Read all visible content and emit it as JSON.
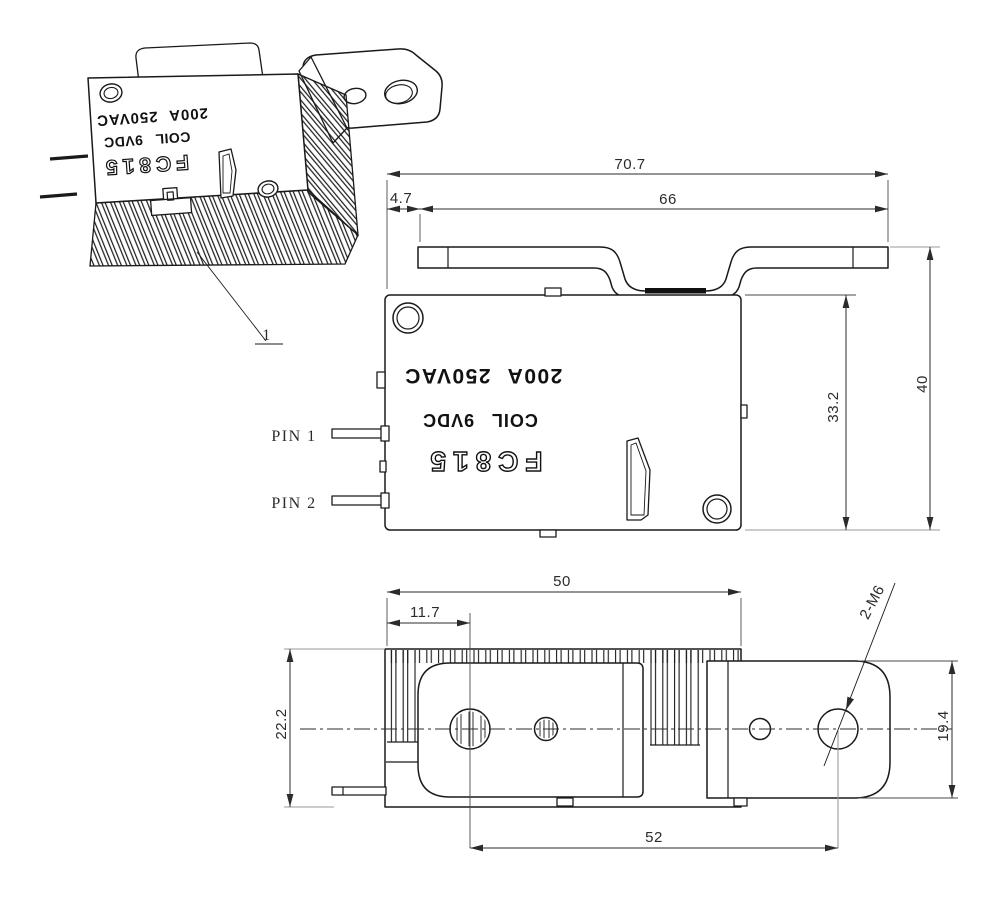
{
  "drawing": {
    "product": {
      "model": "FC815",
      "coil": "COIL 9VDC",
      "rating": "200A 250VAC"
    },
    "isometric": {
      "balloon": "1"
    },
    "front": {
      "dim_overall_width": "70.7",
      "dim_busbar_width": "66",
      "dim_busbar_offset": "4.7",
      "dim_body_height": "33.2",
      "dim_overall_height": "40",
      "pin1_label": "PIN 1",
      "pin2_label": "PIN 2"
    },
    "bottom": {
      "dim_body_width": "50",
      "dim_hole_offset": "11.7",
      "dim_body_depth": "22.2",
      "dim_bracket_depth": "19.4",
      "dim_hole_spacing": "52",
      "thread_callout": "2-M6"
    },
    "colors": {
      "line": "#1a1a1a",
      "dim": "#2b2b2b",
      "ext_gray": "#9a9a9a",
      "background": "#ffffff"
    }
  }
}
